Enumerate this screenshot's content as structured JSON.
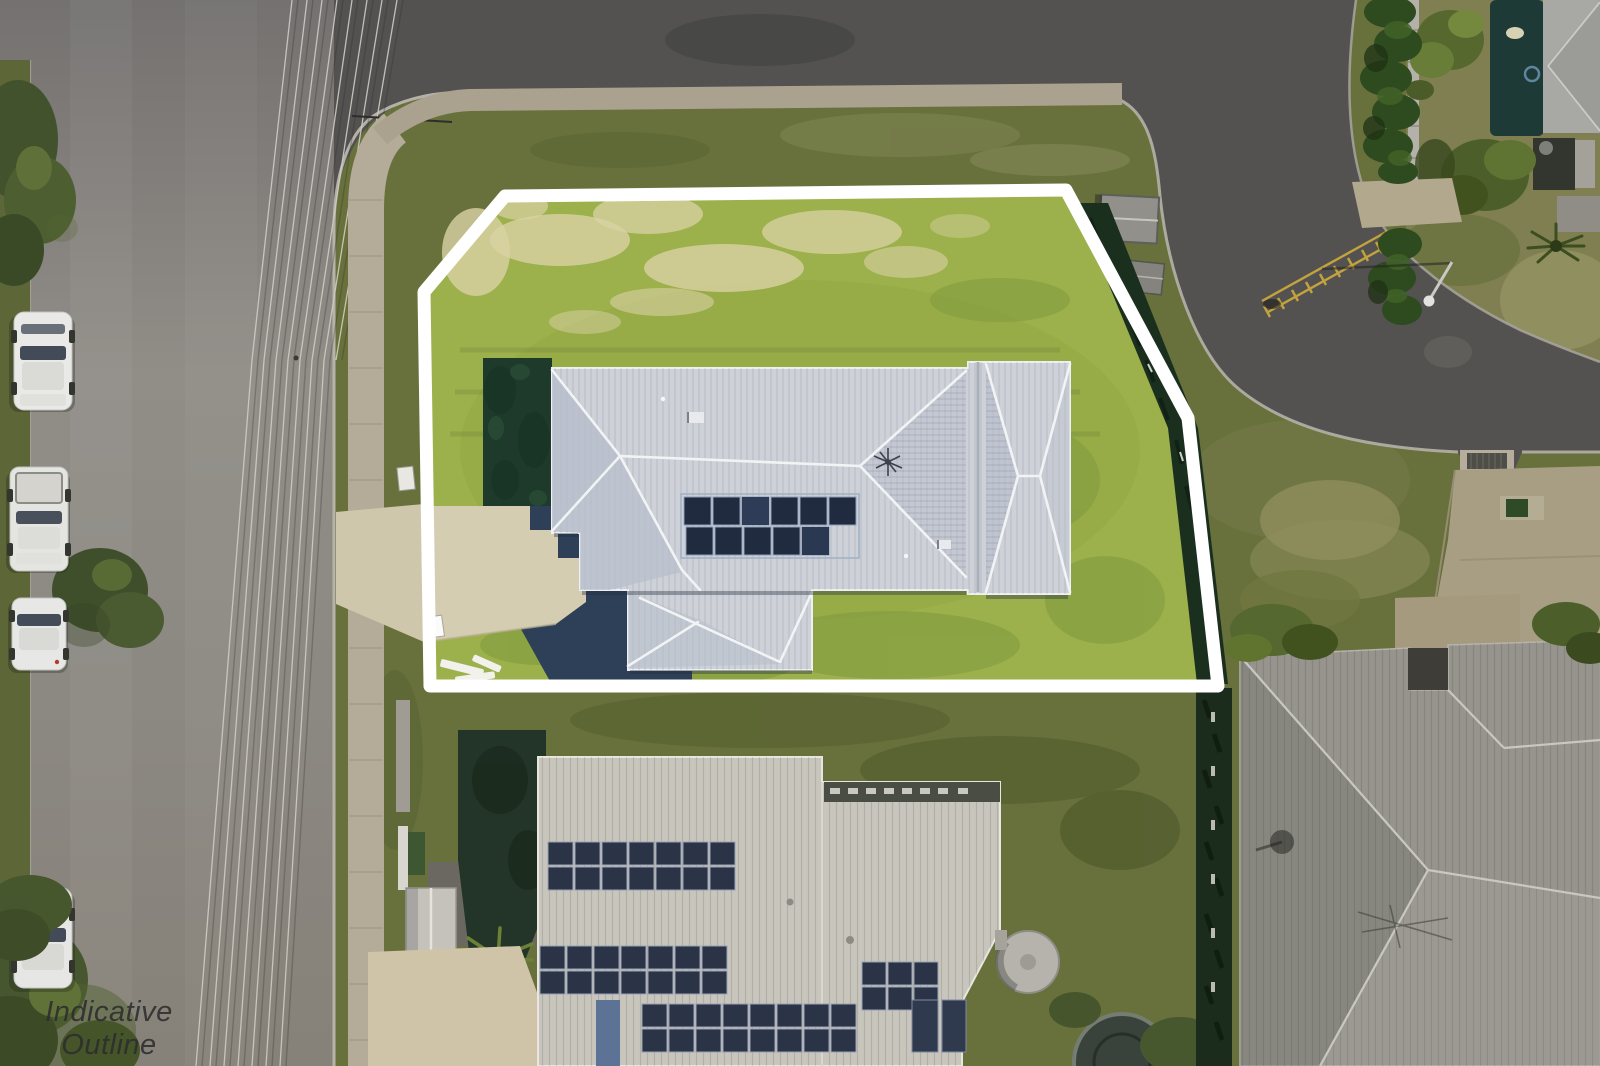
{
  "meta": {
    "image_type": "aerial-drone-photograph",
    "subject": "vacant-style corner allotment with new single-storey house, white indicative boundary outline",
    "watermark_present": true
  },
  "watermark": {
    "line1": "Indicative Outline",
    "line2": "Only"
  },
  "boundary": {
    "stroke": "#ffffff",
    "label": "indicative property outline"
  },
  "palette": {
    "road_left": "#898580",
    "road_dark": "#535250",
    "verge_grass": "#68713c",
    "lot_grass": "#9cb04c",
    "lot_grass_dry": "#d9d2a4",
    "hedge_dark": "#1b2f1e",
    "teal_hedge": "#1d3a2b",
    "shadow_navy": "#2e3f58",
    "roof_main": "#ced2d8",
    "roof_ridge": "#f1f3f5",
    "roof_shade": "#b6bdcb",
    "solar_panel": "#212b40",
    "driveway_beige": "#d5cdb2",
    "footpath": "#b4ab98",
    "curb": "#b5b1a8",
    "neighbor_roof_south": "#c8c5bc",
    "neighbor_roof_southeast": "#96948c",
    "neighbor_roof_northeast": "#9b9b97",
    "pool_teal": "#1e3a36",
    "car_white": "#e9e9e7",
    "road_marking_yellow": "#c9a83c",
    "power_line": "#cfccc5",
    "tank_gray": "#b5b3ac",
    "trampoline_dark": "#3a423c"
  },
  "scene": {
    "parked_car_count": 4,
    "solar_panel_rows_main_house": 2,
    "objects": [
      "white indicative boundary outline",
      "main house hip roof",
      "rooftop solar array",
      "concrete driveway",
      "lot lawn with dry patches",
      "dark boundary hedges",
      "left street with parked cars",
      "overhead power lines",
      "curving corner street",
      "concrete footpath",
      "pedestrian kerb ramp",
      "yellow speed-hump marking",
      "street light with shadow",
      "garden sheds",
      "neighbour house with solar panels",
      "neighbour house south-east",
      "neighbour house north-east with pool",
      "water tank",
      "trampoline",
      "street trees",
      "watermark text"
    ]
  }
}
